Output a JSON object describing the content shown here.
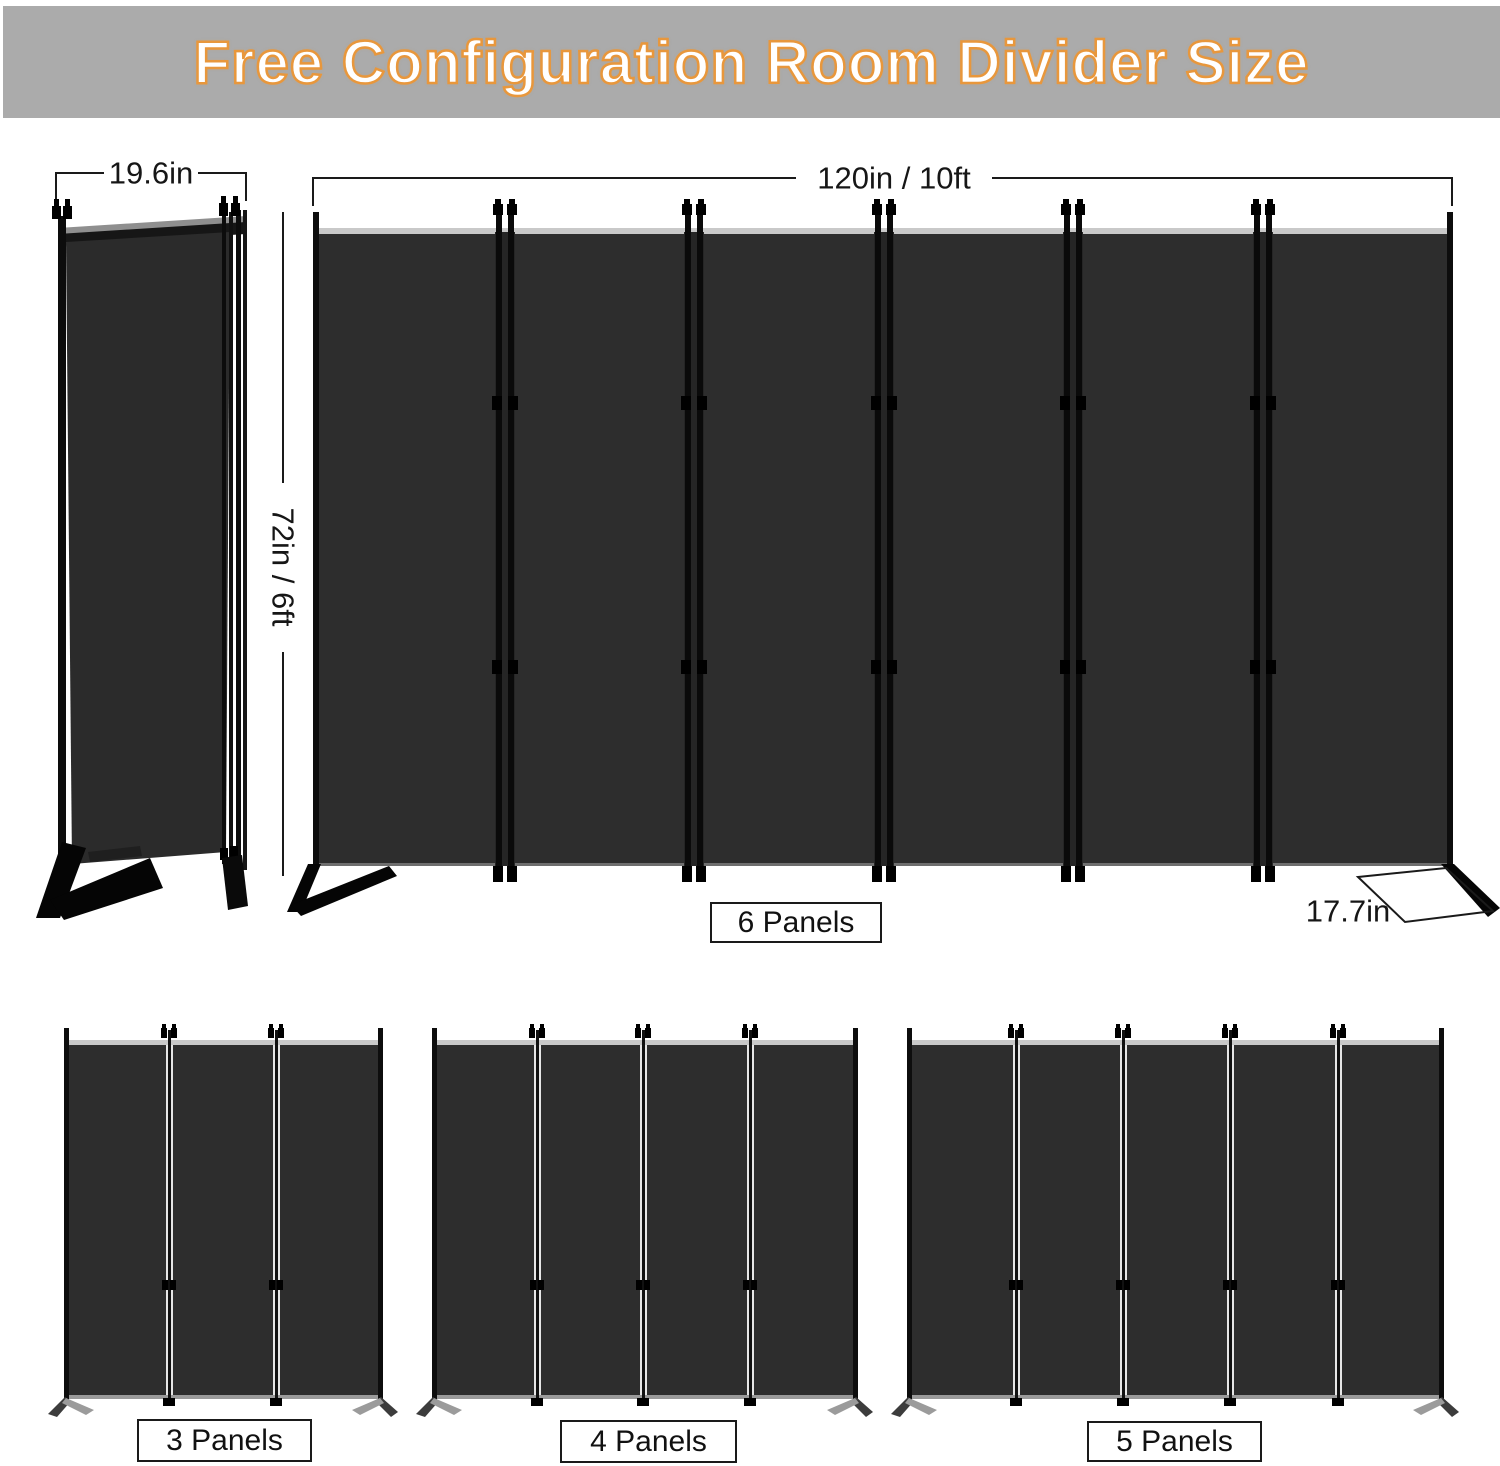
{
  "banner": {
    "title": "Free Configuration Room Divider Size"
  },
  "dimension_labels": {
    "folded_width": "19.6in",
    "total_width": "120in / 10ft",
    "height": "72in / 6ft",
    "foot_depth": "17.7in"
  },
  "panel_count_labels": {
    "six": "6 Panels",
    "three": "3 Panels",
    "four": "4 Panels",
    "five": "5 Panels"
  },
  "colors": {
    "banner_bg": "#ABABAB",
    "title_fill": "#FFFFFF",
    "title_outline": "#E8973C",
    "panel_fabric": "#2D2D2D",
    "frame_black": "#0D0D0D",
    "top_edge_highlight": "#C9C9C9",
    "dimension_line": "#1A1A1A"
  }
}
